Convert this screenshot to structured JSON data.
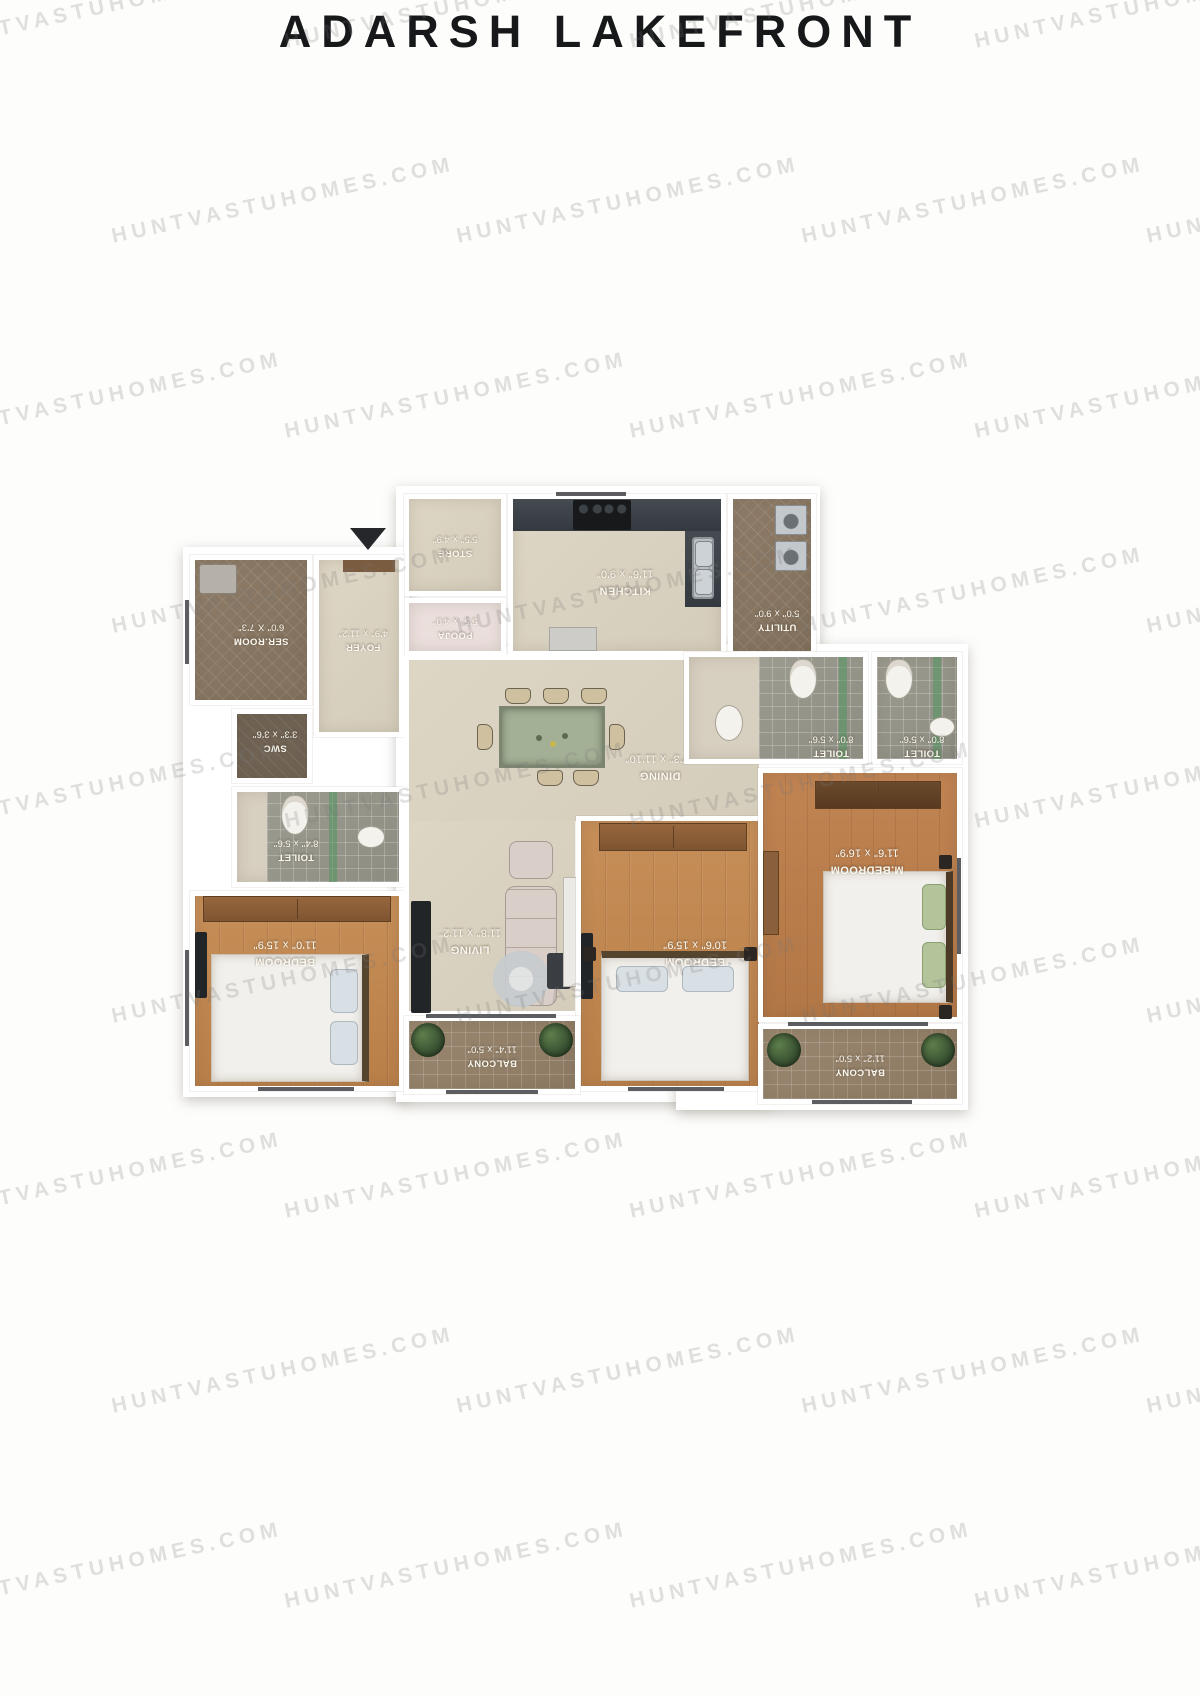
{
  "page": {
    "title": "ADARSH LAKEFRONT"
  },
  "watermark": {
    "text": "HUNTVASTUHOMES.COM"
  },
  "colors": {
    "title": "#17181a",
    "watermark": "#e0e0e0",
    "wall": "#ffffff",
    "floor_beige": "#d9d1c0",
    "floor_wood": "#bf8751",
    "counter_dark": "#3a4146",
    "toilet_accent_green": "#59a06b"
  },
  "plan": {
    "entry_icon": "down-triangle",
    "rooms": {
      "store": {
        "name": "STORE",
        "dims": "5'5\" x 4'9\""
      },
      "kitchen": {
        "name": "KITCHEN",
        "dims": "11'6\" x 9'0\""
      },
      "utility": {
        "name": "UTILITY",
        "dims": "5'0\" x 9'0\""
      },
      "pooja": {
        "name": "POOJA",
        "dims": "5'5\" x 4'0\""
      },
      "foyer": {
        "name": "FOYER",
        "dims": "4'9\" x 11'2\""
      },
      "ser_room": {
        "name": "SER.ROOM",
        "dims": "6'0\" X 7'3\""
      },
      "swc": {
        "name": "SWC",
        "dims": "3'3\" x 3'6\""
      },
      "toilet_bedroom": {
        "name": "TOILET",
        "dims": "8'4\" x 5'6\""
      },
      "toilet_common": {
        "name": "TOILET",
        "dims": "8'0\" x 5'6\""
      },
      "toilet_master": {
        "name": "TOILET",
        "dims": "8'0\" x 5'6\""
      },
      "dining": {
        "name": "DINING",
        "dims": "17'3\" x 11'10\""
      },
      "living": {
        "name": "LIVING",
        "dims": "11'8\" x 11'2\""
      },
      "bedroom_left": {
        "name": "BEDROOM",
        "dims": "11'0\" x 15'9\""
      },
      "bedroom_mid": {
        "name": "BEDROOM",
        "dims": "10'6\" x 15'9\""
      },
      "m_bedroom": {
        "name": "M.BEDROOM",
        "dims": "11'6\" x 16'9\""
      },
      "balcony_mid": {
        "name": "BALCONY",
        "dims": "11'4\" x 5'0\""
      },
      "balcony_right": {
        "name": "BALCONY",
        "dims": "11'2\" x 5'0\""
      }
    }
  }
}
